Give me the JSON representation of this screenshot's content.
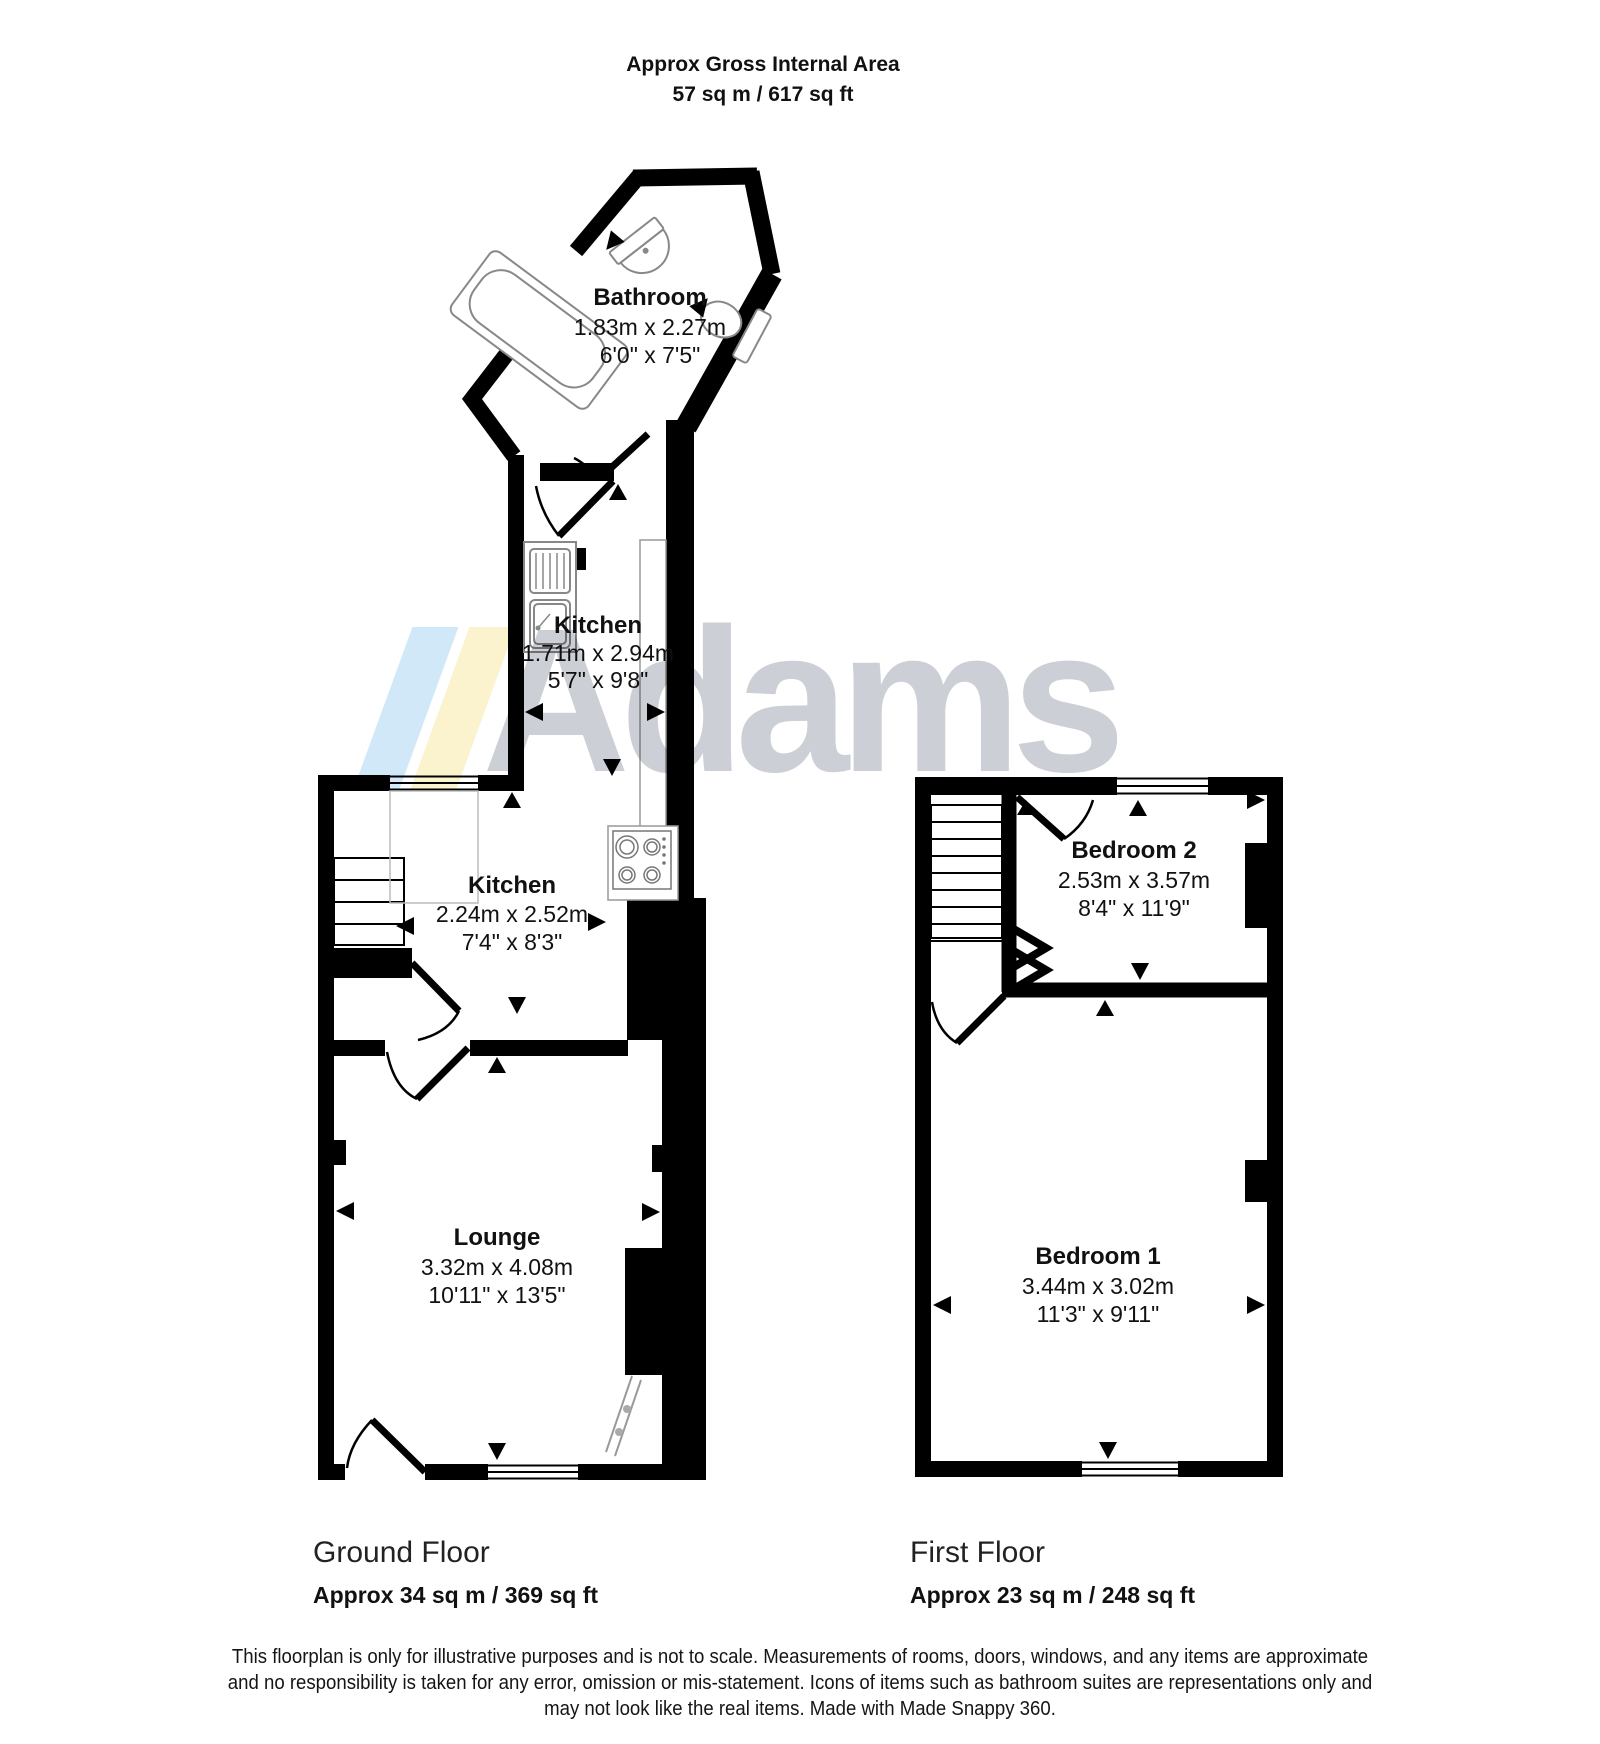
{
  "title": {
    "line1": "Approx Gross Internal Area",
    "line2": "57 sq m / 617 sq ft"
  },
  "rooms": {
    "bathroom": {
      "name": "Bathroom",
      "metric": "1.83m x 2.27m",
      "imperial": "6'0\" x 7'5\""
    },
    "kitchen_rear": {
      "name": "Kitchen",
      "metric": "1.71m x 2.94m",
      "imperial": "5'7\" x 9'8\""
    },
    "kitchen_main": {
      "name": "Kitchen",
      "metric": "2.24m x 2.52m",
      "imperial": "7'4\" x 8'3\""
    },
    "lounge": {
      "name": "Lounge",
      "metric": "3.32m x 4.08m",
      "imperial": "10'11\" x 13'5\""
    },
    "bedroom_2": {
      "name": "Bedroom 2",
      "metric": "2.53m x 3.57m",
      "imperial": "8'4\" x 11'9\""
    },
    "bedroom_1": {
      "name": "Bedroom 1",
      "metric": "3.44m x 3.02m",
      "imperial": "11'3\" x 9'11\""
    }
  },
  "floors": {
    "ground": {
      "name": "Ground Floor",
      "area": "Approx 34 sq m / 369 sq ft"
    },
    "first": {
      "name": "First Floor",
      "area": "Approx 23 sq m / 248 sq ft"
    }
  },
  "watermark": {
    "text": "Adams",
    "stripe1_color": "#cfe7f8",
    "stripe2_color": "#faf3cb",
    "text_color": "#c9ced4"
  },
  "disclaimer": {
    "lines": [
      "This floorplan is only for illustrative purposes and is not to scale. Measurements of rooms, doors, windows, and any items are approximate",
      "and no responsibility is taken for any error, omission or mis-statement. Icons of items such as bathroom suites are representations only and",
      "may not look like the real items. Made with Made Snappy 360."
    ]
  }
}
